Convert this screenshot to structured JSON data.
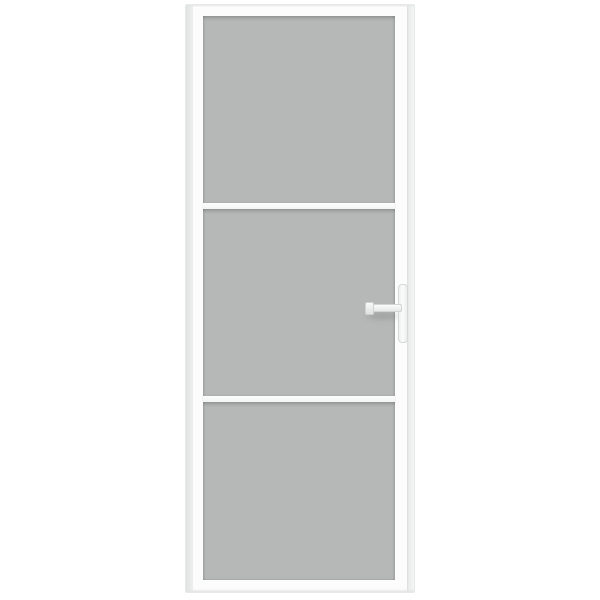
{
  "image": {
    "type": "product-photo",
    "subject": "White interior door with three frosted glass panels, two horizontal white glazing bars and a white lever handle on the right side, on a plain white background"
  },
  "colors": {
    "background": "#ffffff",
    "frame": "#fcfcfc",
    "frame_edge": "#e1e3e3",
    "outline": "#e7e9e9",
    "glass": "#b6b8b8",
    "glass_edge_shadow": "#9fa1a1",
    "divider": "#f3f4f4",
    "divider_shadow": "#c9cbcb",
    "handle": "#f5f6f6",
    "handle_outline": "#d6d8d8"
  },
  "door": {
    "panel_count": 3,
    "glazing_bar_count": 2,
    "handle": {
      "type": "lever",
      "side": "right"
    },
    "parts": {
      "panel_top": "frosted-glass-panel-top",
      "panel_middle": "frosted-glass-panel-middle",
      "panel_bottom": "frosted-glass-panel-bottom",
      "bar_1": "glazing-bar-upper",
      "bar_2": "glazing-bar-lower",
      "backplate": "handle-backplate",
      "lever": "handle-lever"
    }
  }
}
